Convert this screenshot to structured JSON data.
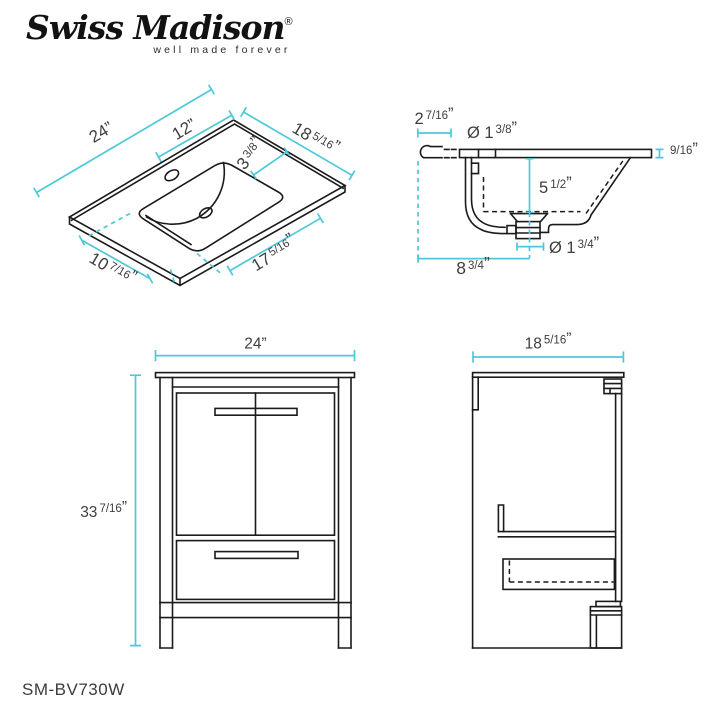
{
  "brand": {
    "name": "Swiss Madison",
    "reg": "®",
    "tagline": "well made forever"
  },
  "model": "SM-BV730W",
  "colors": {
    "accent_cyan": "#4cc9d9",
    "line_black": "#1b1b1b",
    "text_gray": "#3e3e3e"
  },
  "dims": {
    "top_view": {
      "w24": {
        "whole": "24",
        "frac": "",
        "unit": "”"
      },
      "w12": {
        "whole": "12",
        "frac": "",
        "unit": "”"
      },
      "d18": {
        "whole": "18",
        "frac": "5/16",
        "unit": "”"
      },
      "b3": {
        "whole": "3",
        "frac": "3/8",
        "unit": "”"
      },
      "f10": {
        "whole": "10",
        "frac": "7/16",
        "unit": "”"
      },
      "f17": {
        "whole": "17",
        "frac": "5/16",
        "unit": "”"
      }
    },
    "section": {
      "overhang": {
        "whole": "2",
        "frac": "7/16",
        "unit": "”"
      },
      "faucet": {
        "whole": "Ø 1",
        "frac": "3/8",
        "unit": "”"
      },
      "thickness": {
        "whole": "",
        "frac": "9/16",
        "unit": "”"
      },
      "depth": {
        "whole": "5",
        "frac": "1/2",
        "unit": "”"
      },
      "drain": {
        "whole": "Ø 1",
        "frac": "3/4",
        "unit": "”"
      },
      "width": {
        "whole": "8",
        "frac": "3/4",
        "unit": "”"
      }
    },
    "front": {
      "width": {
        "whole": "24",
        "frac": "",
        "unit": "”"
      },
      "height": {
        "whole": "33",
        "frac": "7/16",
        "unit": "”"
      }
    },
    "side": {
      "depth": {
        "whole": "18",
        "frac": "5/16",
        "unit": "”"
      }
    }
  }
}
